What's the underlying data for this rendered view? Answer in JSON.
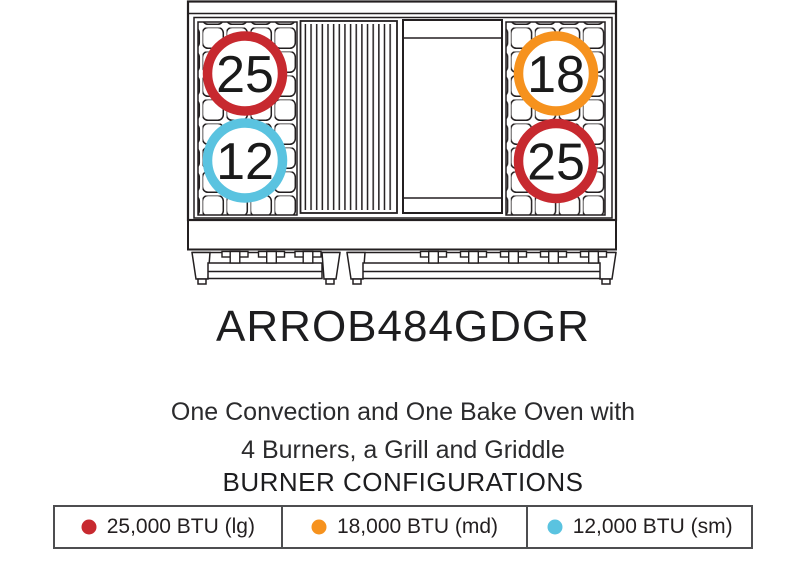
{
  "model": {
    "name": "ARROB484GDGR"
  },
  "description": {
    "line1": "One Convection and One Bake Oven with",
    "line2": "4 Burners, a Grill and Griddle"
  },
  "section_heading": "BURNER CONFIGURATIONS",
  "colors": {
    "line": "#231f20",
    "red": "#c7292f",
    "orange": "#f6921e",
    "blue": "#5ac3e0"
  },
  "diagram": {
    "burners": [
      {
        "position": "left-top",
        "btu_label": "25",
        "color": "#c7292f"
      },
      {
        "position": "left-bottom",
        "btu_label": "12",
        "color": "#5ac3e0"
      },
      {
        "position": "right-top",
        "btu_label": "18",
        "color": "#f6921e"
      },
      {
        "position": "right-bottom",
        "btu_label": "25",
        "color": "#c7292f"
      }
    ]
  },
  "legend": {
    "items": [
      {
        "label": "25,000 BTU (lg)",
        "color": "#c7292f"
      },
      {
        "label": "18,000 BTU (md)",
        "color": "#f6921e"
      },
      {
        "label": "12,000 BTU (sm)",
        "color": "#5ac3e0"
      }
    ]
  }
}
